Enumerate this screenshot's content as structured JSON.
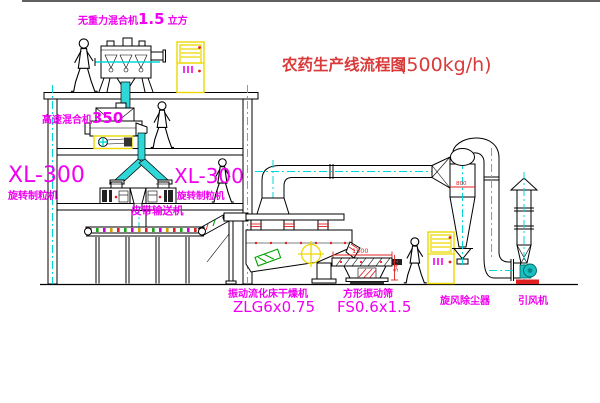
{
  "diagram": {
    "title": "农药生产线流程图",
    "capacity": "(500kg/h)"
  },
  "labels": {
    "gravity_mixer_name": "无重力混合机",
    "gravity_mixer_size": "1.5",
    "gravity_mixer_unit": "立方",
    "high_speed_mixer_name": "高速混合机",
    "high_speed_mixer_size": "350",
    "granulator_model": "XL-300",
    "granulator_name": "旋转制粒机",
    "granulator2_model": "XL-300",
    "granulator2_name": "旋转制粒机",
    "belt_conveyor": "皮带输送机",
    "dryer_name": "振动流化床干燥机",
    "dryer_model": "ZLG6x0.75",
    "sieve_name": "方形振动筛",
    "sieve_model": "FS0.6x1.5",
    "cyclone_name": "旋风除尘器",
    "fan_name": "引风机"
  },
  "dimensions": {
    "sieve_length": "1500",
    "sieve_height": "541",
    "cyclone_width": "800"
  },
  "symbols": {
    "person": "walking-worker-figure",
    "motor_mark": "yellow-crosshair-circle",
    "control_cabinet": "electric-control-cabinet"
  },
  "colors": {
    "outline": "#000000",
    "centerline_cyan": "#00d8d8",
    "pipe_cyan": "#2fd8d8",
    "highlight_yellow": "#f0dc00",
    "accent_red": "#e02020",
    "label_magenta": "#f000f0",
    "title_red": "#d93a3a",
    "machine_green": "#00a000"
  }
}
